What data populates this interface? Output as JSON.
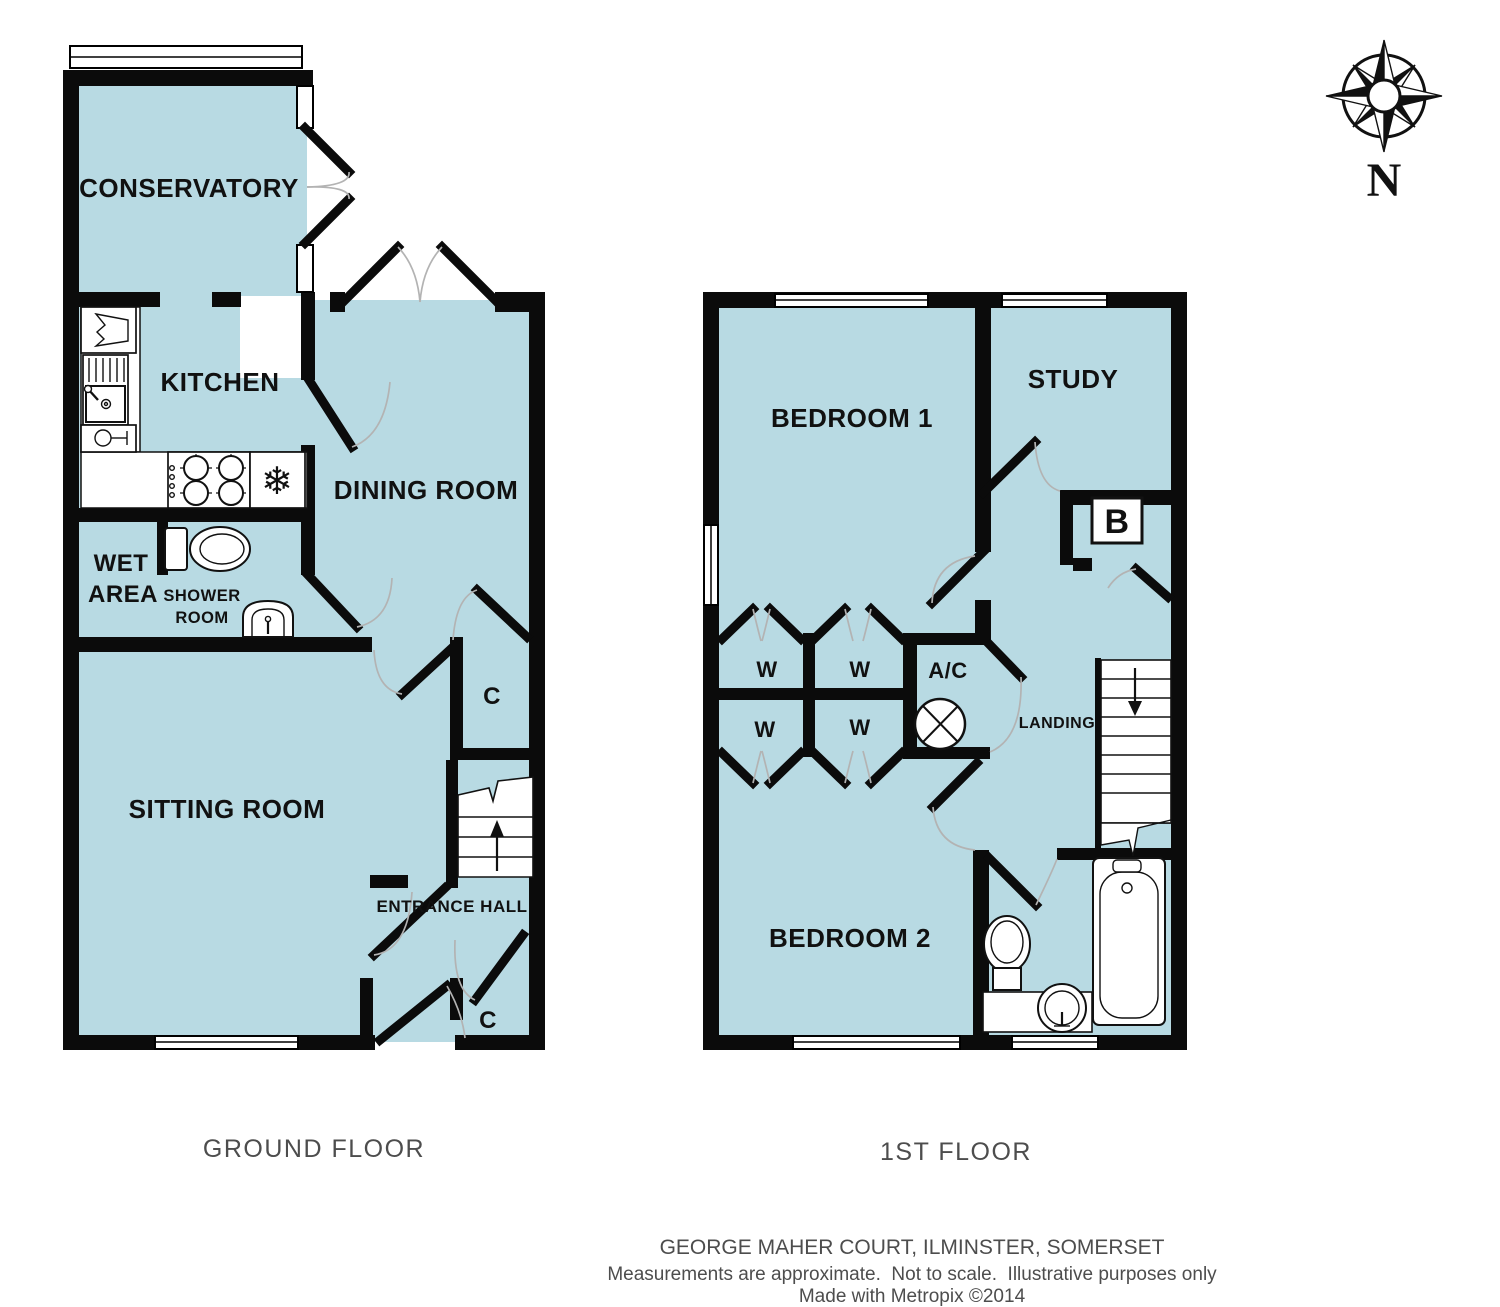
{
  "ground_floor": {
    "floor_label": "GROUND FLOOR",
    "rooms": {
      "conservatory": "CONSERVATORY",
      "kitchen": "KITCHEN",
      "dining_room": "DINING ROOM",
      "wet_area_line1": "WET",
      "wet_area_line2": "AREA",
      "shower_room_line1": "SHOWER",
      "shower_room_line2": "ROOM",
      "sitting_room": "SITTING ROOM",
      "entrance_hall": "ENTRANCE HALL",
      "cupboard": "C"
    }
  },
  "first_floor": {
    "floor_label": "1ST FLOOR",
    "rooms": {
      "bedroom1": "BEDROOM 1",
      "study": "STUDY",
      "bedroom2": "BEDROOM 2",
      "landing": "LANDING",
      "wardrobe": "W",
      "airing_cupboard": "A/C",
      "boiler": "B"
    }
  },
  "symbols": {
    "freezer_symbol": "❄"
  },
  "compass": {
    "north_label": "N"
  },
  "footer": {
    "address": "GEORGE MAHER COURT, ILMINSTER, SOMERSET",
    "disclaimer": "Measurements are approximate.  Not to scale.  Illustrative purposes only",
    "credit": "Made with Metropix ©2014"
  },
  "colors": {
    "room_fill": "#B8DAE3",
    "wall": "#0B0B0B",
    "door_arc": "#B3B3B3",
    "room_label": "#111111",
    "floor_label": "#4D4D4D",
    "footer_text": "#4D4D4D"
  }
}
